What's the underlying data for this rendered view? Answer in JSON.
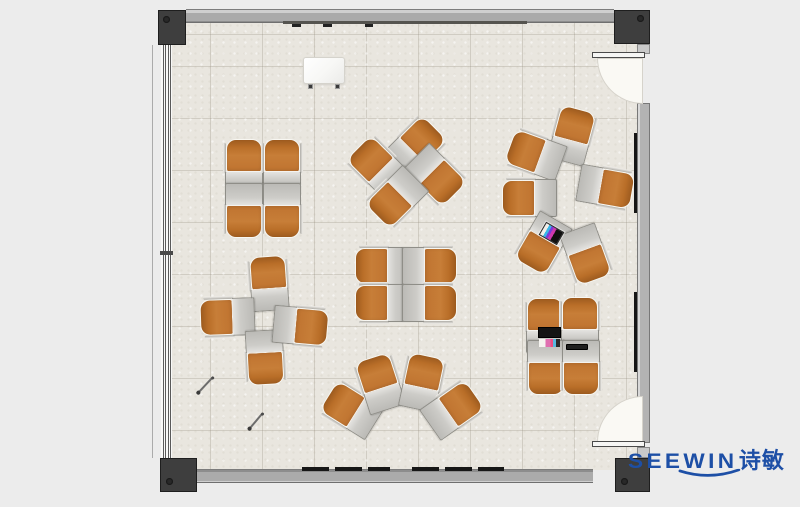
{
  "meta": {
    "type": "floor-plan",
    "description": "Top-view classroom / training room furniture layout with clusters of single-seat desks and chairs"
  },
  "branding": {
    "wordmark": "SEEWIN",
    "cjk": "诗敏",
    "color": "#1d4fa6"
  },
  "palette": {
    "outside_bg": "#ececec",
    "floor": "#e9e6df",
    "wall_gray": "#ababab",
    "column_dark": "#3e3e3e",
    "chair_orange": "#c0752f",
    "desk_gray": "#c6c5c1",
    "door_swing": "#faf9f4",
    "board_black": "#161616",
    "logo_blue": "#1d4fa6"
  },
  "furniture": {
    "unit_size": {
      "w": 40,
      "h": 56
    },
    "units": [
      {
        "x": 244,
        "y": 167,
        "r": 0
      },
      {
        "x": 282,
        "y": 167,
        "r": 0
      },
      {
        "x": 244,
        "y": 210,
        "r": 180
      },
      {
        "x": 282,
        "y": 210,
        "r": 180
      },
      {
        "x": 415,
        "y": 147,
        "r": 45
      },
      {
        "x": 378,
        "y": 167,
        "r": -45
      },
      {
        "x": 435,
        "y": 175,
        "r": 135
      },
      {
        "x": 397,
        "y": 197,
        "r": 225
      },
      {
        "x": 572,
        "y": 136,
        "r": 15
      },
      {
        "x": 536,
        "y": 155,
        "r": -70
      },
      {
        "x": 530,
        "y": 198,
        "r": -90
      },
      {
        "x": 543,
        "y": 243,
        "r": 210
      },
      {
        "x": 605,
        "y": 187,
        "r": 100
      },
      {
        "x": 586,
        "y": 254,
        "r": 160
      },
      {
        "x": 383,
        "y": 266,
        "r": 270
      },
      {
        "x": 429,
        "y": 266,
        "r": 90
      },
      {
        "x": 383,
        "y": 303,
        "r": 270
      },
      {
        "x": 429,
        "y": 303,
        "r": 90
      },
      {
        "x": 269,
        "y": 284,
        "r": -4
      },
      {
        "x": 228,
        "y": 317,
        "r": 268
      },
      {
        "x": 265,
        "y": 357,
        "r": 177
      },
      {
        "x": 300,
        "y": 326,
        "r": 95
      },
      {
        "x": 352,
        "y": 410,
        "r": -58
      },
      {
        "x": 380,
        "y": 384,
        "r": -18
      },
      {
        "x": 422,
        "y": 383,
        "r": 12
      },
      {
        "x": 452,
        "y": 410,
        "r": 55
      },
      {
        "x": 545,
        "y": 326,
        "r": 0
      },
      {
        "x": 580,
        "y": 325,
        "r": 0
      },
      {
        "x": 546,
        "y": 367,
        "r": 180
      },
      {
        "x": 581,
        "y": 367,
        "r": 180
      }
    ],
    "accessories": [
      {
        "type": "easel",
        "name": "mobile-whiteboard-easel",
        "x": 324,
        "y": 70,
        "w": 42,
        "h": 27,
        "r": 0
      },
      {
        "type": "laptop-open",
        "name": "open-laptop",
        "x": 549,
        "y": 337,
        "w": 23,
        "h": 20,
        "r": 0
      },
      {
        "type": "tablet",
        "name": "closed-tablet",
        "x": 577,
        "y": 347,
        "w": 22,
        "h": 6,
        "r": 0
      },
      {
        "type": "laptop-color",
        "name": "open-laptop-colorful",
        "x": 551,
        "y": 233,
        "w": 21,
        "h": 15,
        "r": 210
      },
      {
        "type": "pen",
        "name": "pen-on-floor",
        "x": 205,
        "y": 385,
        "w": 21,
        "h": 2,
        "r": -47
      },
      {
        "type": "pen",
        "name": "pen-on-floor",
        "x": 256,
        "y": 421,
        "w": 20,
        "h": 2,
        "r": -50
      }
    ]
  }
}
